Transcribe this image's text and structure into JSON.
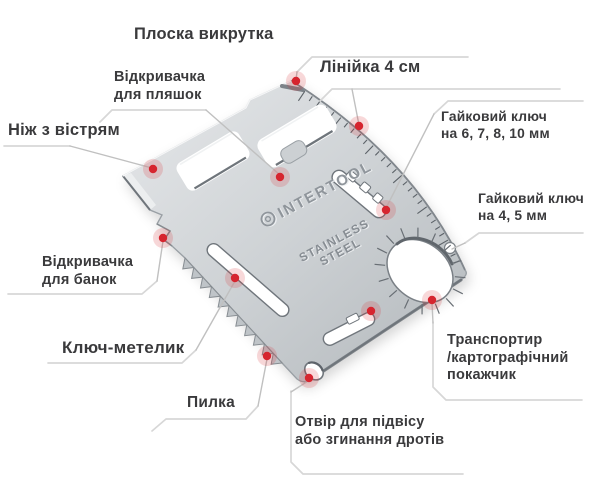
{
  "card": {
    "brand": "INTERTOOL",
    "material_line1": "STAINLESS",
    "material_line2": "STEEL"
  },
  "callouts": {
    "flat_screwdriver": "Плоска викрутка",
    "ruler": "Лінійка 4 см",
    "wrench_6_10": "Гайковий ключ\nна 6, 7, 8, 10 мм",
    "wrench_4_5": "Гайковий ключ\nна 4, 5 мм",
    "bottle_opener": "Відкривачка\nдля пляшок",
    "knife": "Ніж з вістрям",
    "can_opener": "Відкривачка\nдля банок",
    "butterfly_wrench": "Ключ-метелик",
    "saw": "Пилка",
    "hang_hole": "Отвір для підвісу\nабо згинання дротів",
    "protractor": "Транспортир\n/картографічний\nпокажчик"
  },
  "colors": {
    "marker_red": "#d6252f",
    "bracket_gray": "#d7d7d7",
    "connector_gray": "#c0c0c0",
    "label_text": "#3a3a3c",
    "metal_light": "#e2e4e6",
    "metal_dark": "#aab0b4"
  }
}
